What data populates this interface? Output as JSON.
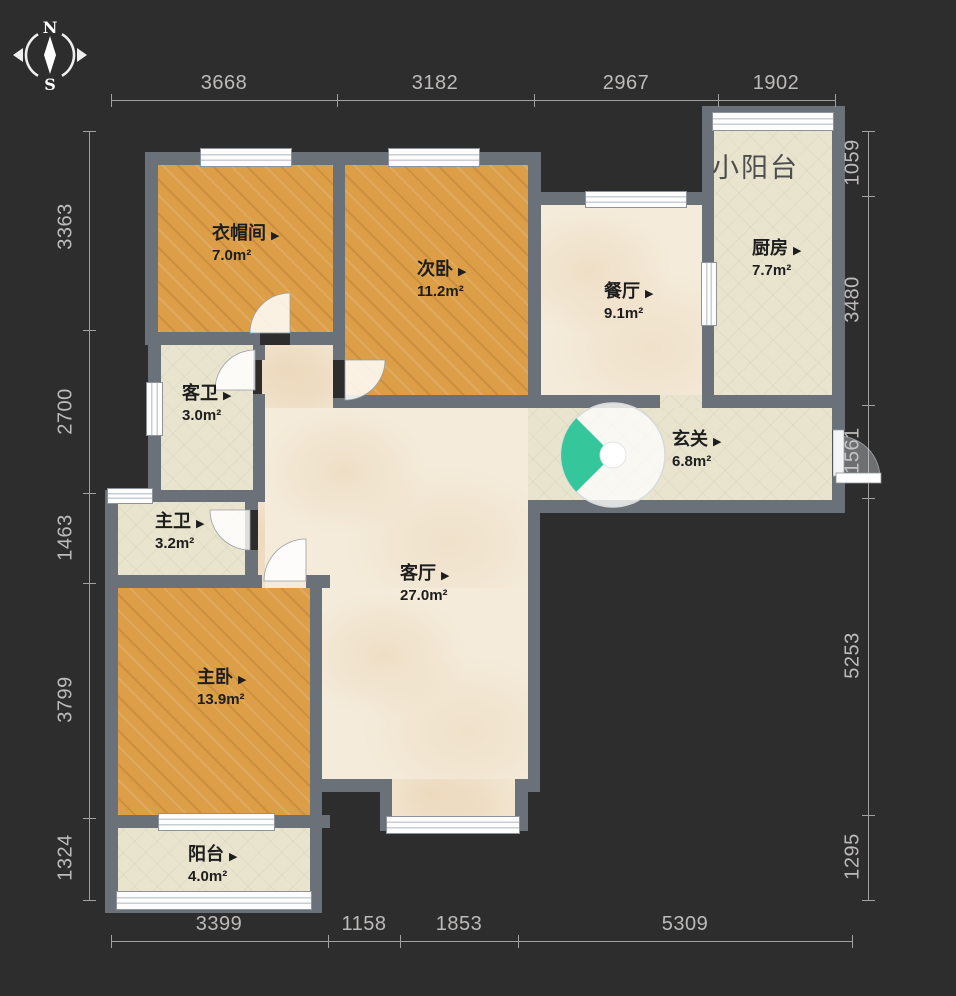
{
  "compass": {
    "north": "N",
    "south": "S"
  },
  "ui": {
    "room_arrow": "▶"
  },
  "rooms": {
    "cloakroom": {
      "name": "衣帽间",
      "area": "7.0m²"
    },
    "second_bedroom": {
      "name": "次卧",
      "area": "11.2m²"
    },
    "dining": {
      "name": "餐厅",
      "area": "9.1m²"
    },
    "kitchen": {
      "name": "厨房",
      "area": "7.7m²"
    },
    "small_balcony": {
      "name": "小阳台",
      "area": ""
    },
    "guest_bath": {
      "name": "客卫",
      "area": "3.0m²"
    },
    "entrance": {
      "name": "玄关",
      "area": "6.8m²"
    },
    "master_bath": {
      "name": "主卫",
      "area": "3.2m²"
    },
    "living": {
      "name": "客厅",
      "area": "27.0m²"
    },
    "master_bedroom": {
      "name": "主卧",
      "area": "13.9m²"
    },
    "balcony": {
      "name": "阳台",
      "area": "4.0m²"
    }
  },
  "dimensions": {
    "top": [
      "3668",
      "3182",
      "2967",
      "1902"
    ],
    "bottom": [
      "3399",
      "1158",
      "1853",
      "5309"
    ],
    "left": [
      "3363",
      "2700",
      "1463",
      "3799",
      "1324"
    ],
    "right": [
      "1059",
      "3480",
      "1561",
      "5253",
      "1295"
    ]
  },
  "colors": {
    "background": "#2e2d2d",
    "wall": "#6b7178",
    "wood_floor": "#dc9e47",
    "marble_floor": "#f4ebda",
    "tile_floor": "#e8e4ce",
    "door_fan_teal": "#35c69b",
    "dimension_text": "#bdbbb9"
  }
}
